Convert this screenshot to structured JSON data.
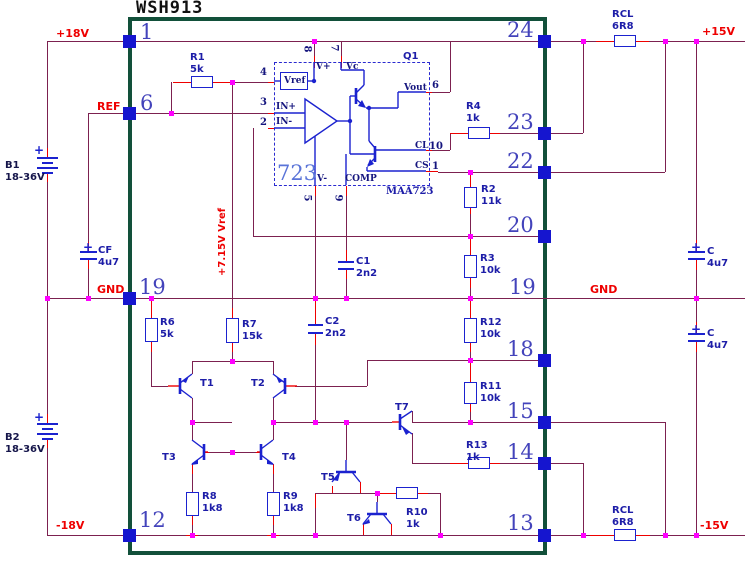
{
  "L": {
    "title": "WSH913",
    "p18": "+18V",
    "ref": "REF",
    "gndl": "GND",
    "gndr": "GND",
    "n18": "-18V",
    "p15": "+15V",
    "n15": "-15V",
    "vref7": "+7.15V Vref",
    "b1": "B1",
    "b1v": "18-36V",
    "b2": "B2",
    "b2v": "18-36V",
    "plus": "+",
    "r1": "R1",
    "r1v": "5k",
    "r2": "R2",
    "r2v": "11k",
    "r3": "R3",
    "r3v": "10k",
    "r4": "R4",
    "r4v": "1k",
    "r6": "R6",
    "r6v": "5k",
    "r7": "R7",
    "r7v": "15k",
    "r8": "R8",
    "r8v": "1k8",
    "r9": "R9",
    "r9v": "1k8",
    "r10": "R10",
    "r10v": "1k",
    "r11": "R11",
    "r11v": "10k",
    "r12": "R12",
    "r12v": "10k",
    "r13": "R13",
    "r13v": "1k",
    "rcl": "RCL",
    "rclv": "6R8",
    "c1": "C1",
    "c1v": "2n2",
    "c2": "C2",
    "c2v": "2n2",
    "cf": "CF",
    "cfv": "4u7",
    "c": "C",
    "cv": "4u7",
    "t1": "T1",
    "t2": "T2",
    "t3": "T3",
    "t4": "T4",
    "t5": "T5",
    "t6": "T6",
    "t7": "T7",
    "q1": "Q1",
    "ic": "723",
    "icp": "MAA723",
    "vref": "Vref",
    "inp": "IN+",
    "inn": "IN-",
    "vp": "V+",
    "vc": "Vc",
    "vn": "V-",
    "comp": "COMP",
    "vout": "Vout",
    "cl": "CL",
    "cs": "CS",
    "n1": "1",
    "n2": "2",
    "n3": "3",
    "n4": "4",
    "n5": "5",
    "n6": "6",
    "n7": "7",
    "n8": "8",
    "n9": "9",
    "n10": "10",
    "pl1": "1",
    "pl6": "6",
    "pl19": "19",
    "pl12": "12",
    "pr24": "24",
    "pr23": "23",
    "pr22": "22",
    "pr20": "20",
    "pr19": "19",
    "pr18": "18",
    "pr15": "15",
    "pr14": "14",
    "pr13": "13"
  }
}
